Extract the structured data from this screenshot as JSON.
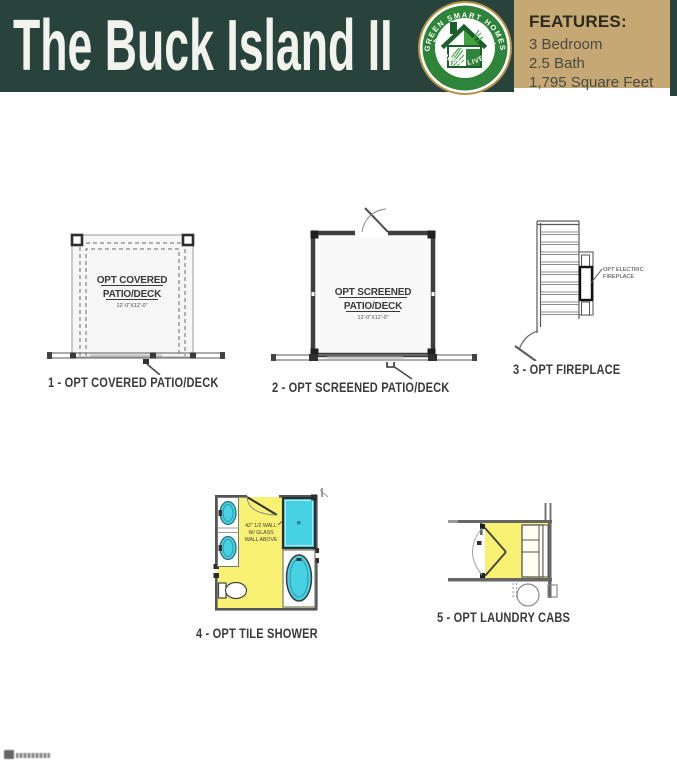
{
  "header": {
    "title": "The Buck Island II",
    "logo": {
      "arc_top": "GREEN SMART HOMES",
      "arc_bottom": "LIVE GREEN. LIVE SMART"
    },
    "features": {
      "heading": "FEATURES:",
      "items": [
        "3 Bedroom",
        "2.5 Bath",
        "1,795 Square Feet"
      ]
    }
  },
  "plans": [
    {
      "caption": "1 - OPT COVERED PATIO/DECK",
      "room_label_1": "OPT COVERED",
      "room_label_2": "PATIO/DECK",
      "dimensions": "12'-0\"X12'-0\""
    },
    {
      "caption": "2 - OPT SCREENED PATIO/DECK",
      "room_label_1": "OPT SCREENED",
      "room_label_2": "PATIO/DECK",
      "dimensions": "12'-0\"X12'-0\""
    },
    {
      "caption": "3 - OPT FIREPLACE",
      "annotation_1": "OPT ELECTRIC",
      "annotation_2": "FIREPLACE"
    },
    {
      "caption": "4 - OPT TILE SHOWER",
      "annotation_1": "42\" 1/2 WALL",
      "annotation_2": "W/ GLASS",
      "annotation_3": "WALL ABOVE"
    },
    {
      "caption": "5 - OPT LAUNDRY CABS"
    }
  ],
  "colors": {
    "header_green": "#27433b",
    "features_tan": "#c6a875",
    "plan_yellow": "#f8f173",
    "plan_cyan": "#47d2e3",
    "logo_green": "#2e8438",
    "logo_gold": "#b99348",
    "caption_color": "#3b3b3b"
  }
}
